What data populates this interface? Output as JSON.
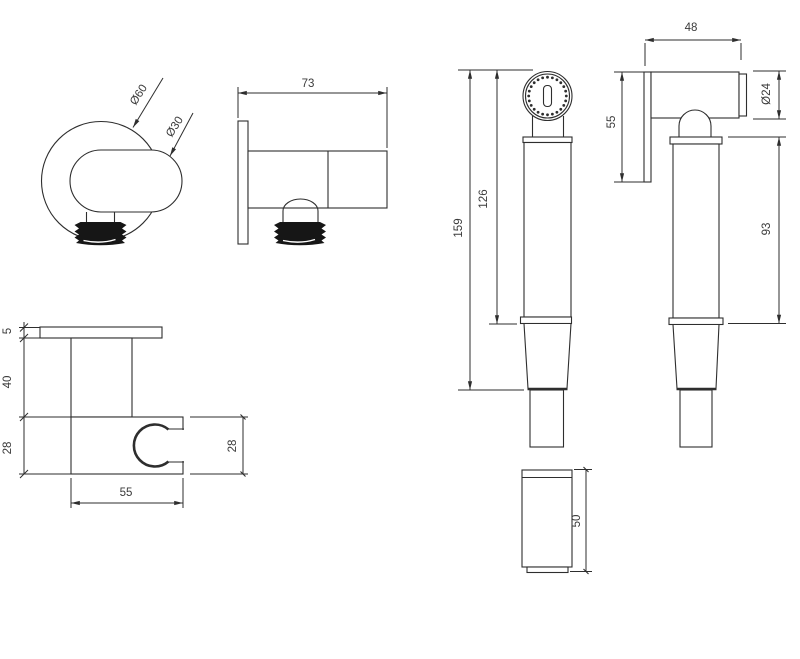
{
  "drawing": {
    "type": "technical-dimension-drawing",
    "subject": "hand spray (shattaf) set with wall outlet, holder and coupling",
    "units": "mm",
    "colors": {
      "line": "#2e2e2e",
      "text": "#3a3a3a",
      "thread_fill": "#161616",
      "background": "#ffffff"
    },
    "views": {
      "outlet_front": {
        "name": "wall outlet - front view",
        "dims": {
          "outer_diameter": "Ø60",
          "body_diameter": "Ø30"
        }
      },
      "outlet_side": {
        "name": "wall outlet - side view",
        "dims": {
          "depth": "73"
        }
      },
      "holder": {
        "name": "holder bracket - side view",
        "dims": {
          "plate_thickness": "5",
          "stem_height": "40",
          "body_height": "28",
          "body_depth": "28",
          "body_width": "55"
        }
      },
      "sprayer_front": {
        "name": "hand spray - front view",
        "dims": {
          "length_to_cone": "126",
          "total_length": "159"
        }
      },
      "sprayer_side": {
        "name": "hand spray - side view",
        "dims": {
          "head_length": "48",
          "cap_diameter": "Ø24",
          "face_height": "55",
          "handle_length": "93"
        }
      },
      "hose_coupling": {
        "name": "hose coupling cylinder",
        "dims": {
          "height": "50"
        }
      }
    }
  }
}
